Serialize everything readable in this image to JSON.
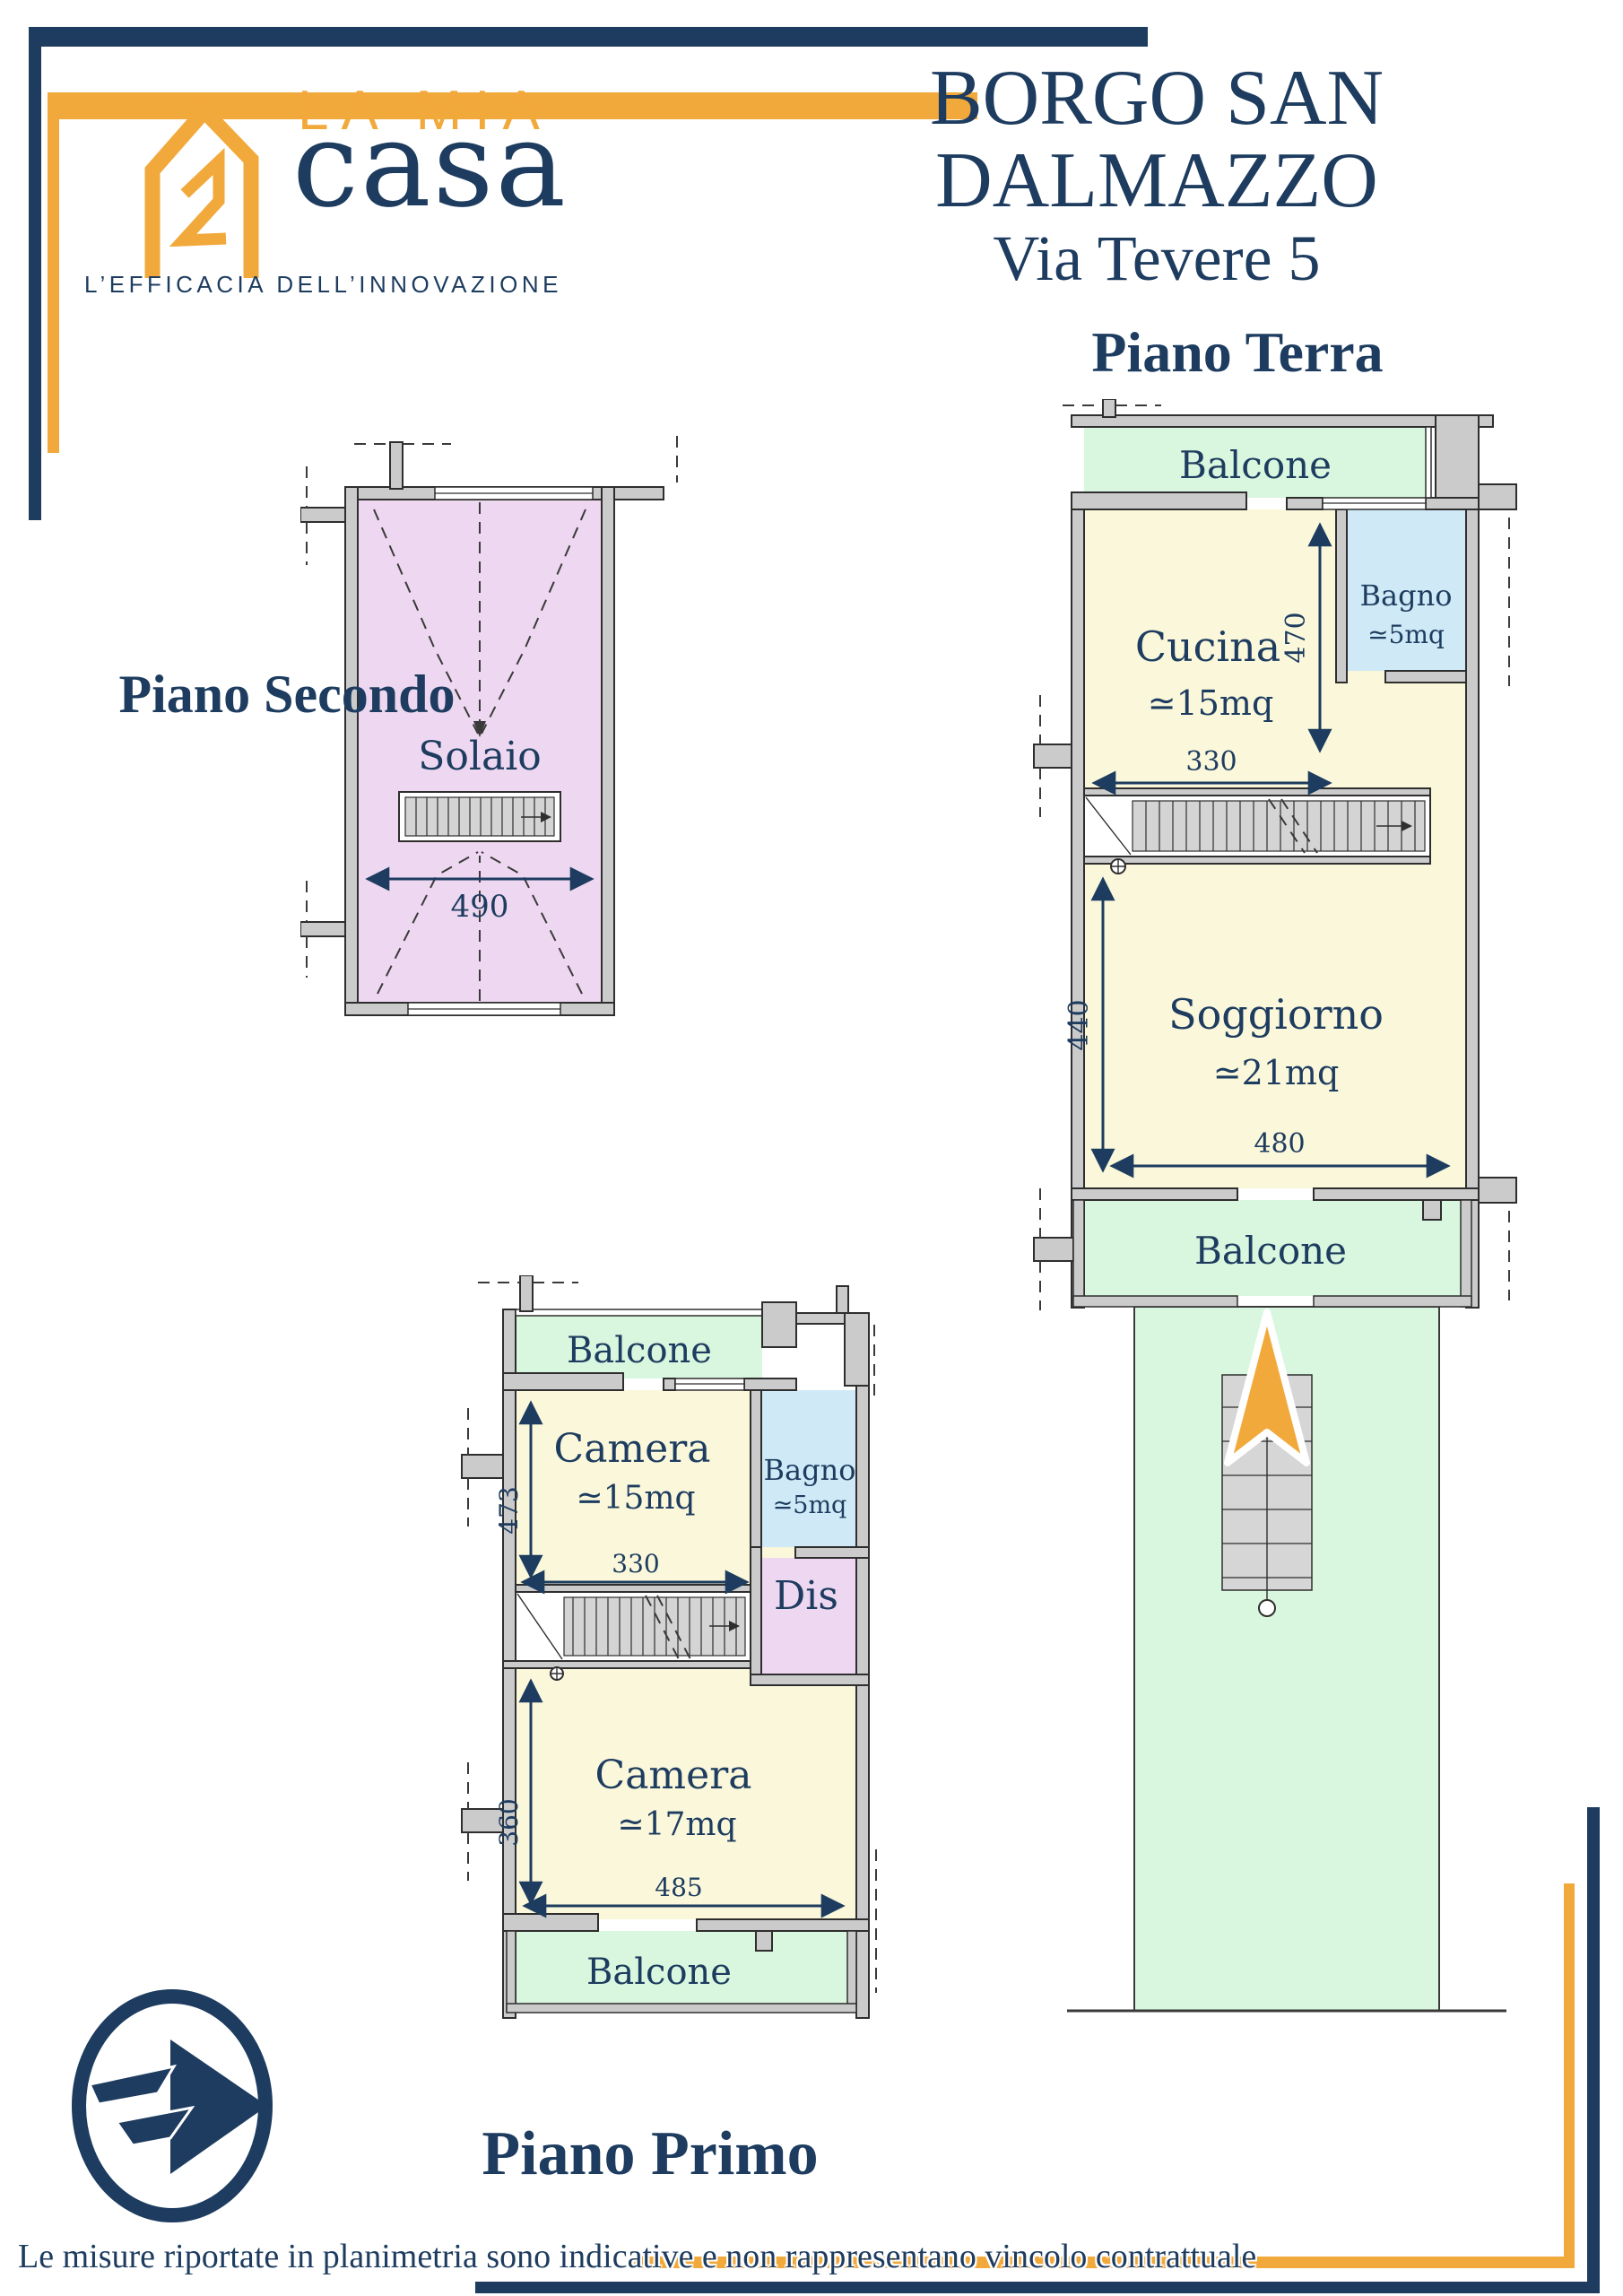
{
  "brand": {
    "name_top": "LA MIA",
    "name_main": "casa",
    "tagline": "L’EFFICACIA DELL’INNOVAZIONE"
  },
  "header": {
    "title": "BORGO SAN DALMAZZO",
    "subtitle": "Via Tevere 5"
  },
  "symbols": {
    "approx": "≃"
  },
  "colors": {
    "navy": "#1d3c5f",
    "orange": "#f2a93b",
    "wall_gray": "#cbcbcb",
    "room_yellow": "#faf7da",
    "balcony_green": "#d9f6de",
    "bath_blue": "#cfe9f6",
    "attic_lavender": "#eed7f0"
  },
  "floor_secondo": {
    "title": "Piano Secondo",
    "room": "Solaio",
    "dim_width": "490"
  },
  "floor_terra": {
    "title": "Piano Terra",
    "balcone_top": "Balcone",
    "cucina": "Cucina",
    "cucina_area": "15mq",
    "cucina_h": "470",
    "cucina_w": "330",
    "bagno": "Bagno",
    "bagno_area": "5mq",
    "soggiorno": "Soggiorno",
    "soggiorno_area": "21mq",
    "soggiorno_h": "440",
    "soggiorno_w": "480",
    "balcone_bottom": "Balcone"
  },
  "floor_primo": {
    "title": "Piano Primo",
    "balcone_top": "Balcone",
    "camera1": "Camera",
    "camera1_area": "15mq",
    "camera1_h": "473",
    "camera1_w": "330",
    "bagno": "Bagno",
    "bagno_area": "5mq",
    "dis": "Dis",
    "camera2": "Camera",
    "camera2_area": "17mq",
    "camera2_h": "360",
    "camera2_w": "485",
    "balcone_bottom": "Balcone"
  },
  "footer": {
    "disclaimer": "Le misure riportate in planimetria sono indicative e non rappresentano vincolo contrattuale"
  }
}
